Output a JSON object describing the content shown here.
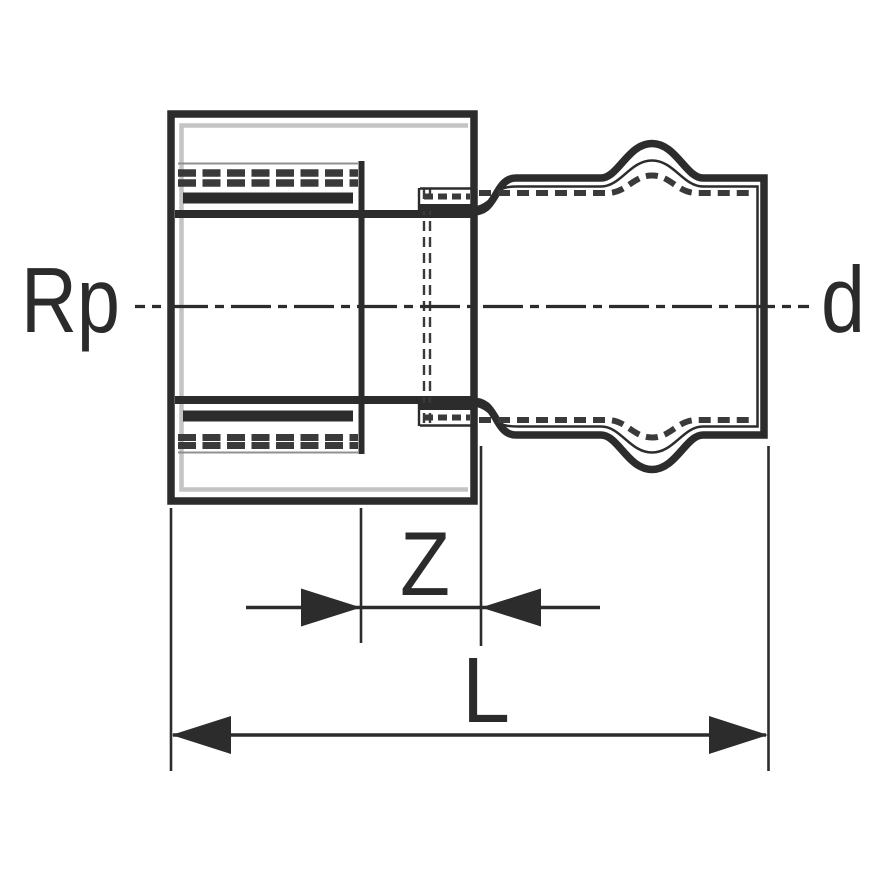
{
  "drawing": {
    "labels": {
      "thread_size": "Rp",
      "outer_diameter": "d",
      "insertion_depth": "Z",
      "overall_length": "L"
    },
    "colors": {
      "line": "#2c2c2c",
      "hatch": "#3a3a3a",
      "echo": "#c4c4c4",
      "faint": "#909090",
      "label": "#2b2b2b"
    }
  }
}
